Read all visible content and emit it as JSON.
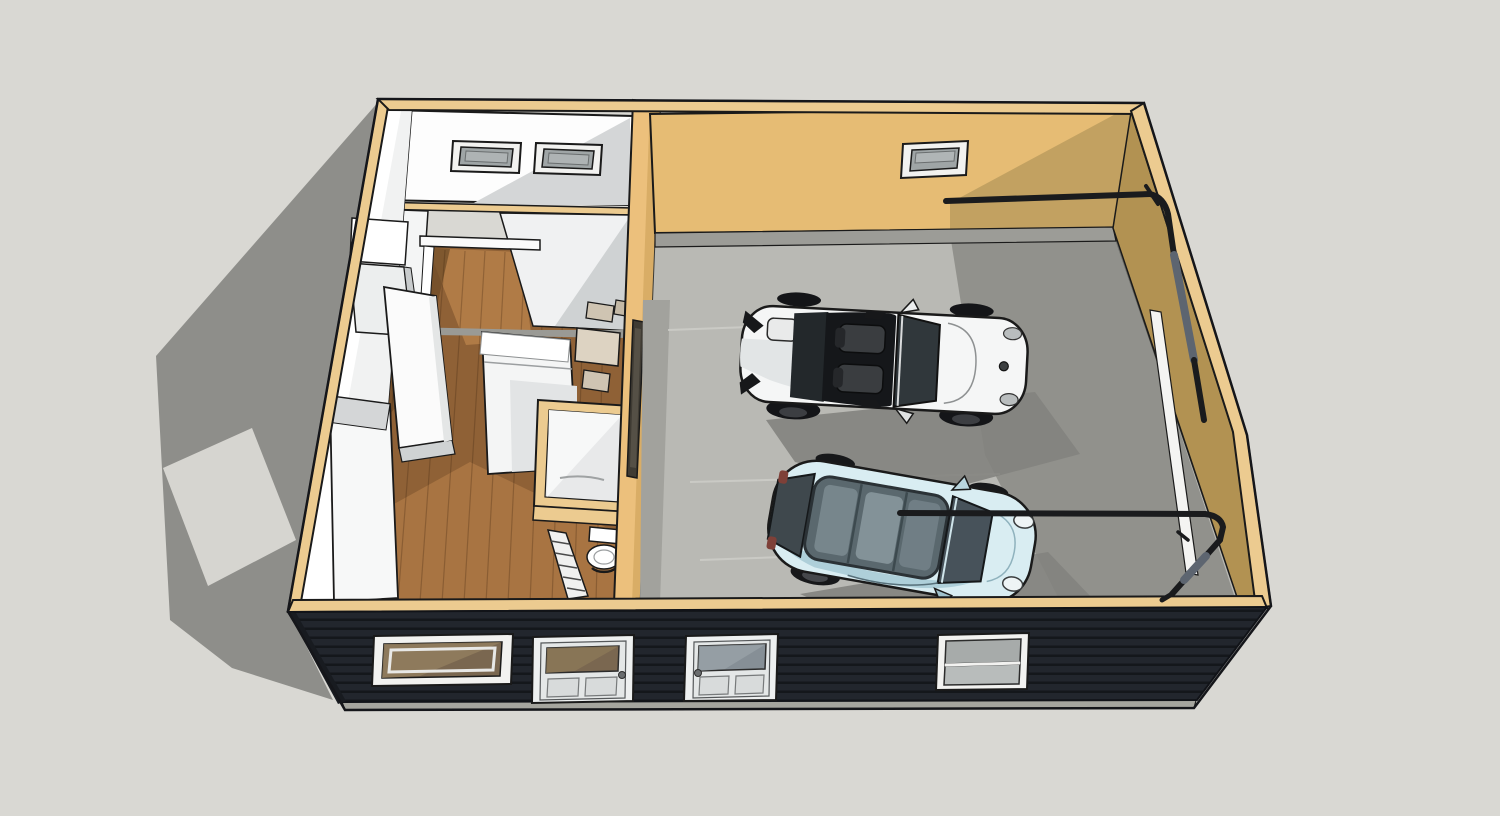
{
  "scene": {
    "type": "3d-model-viewport",
    "description": "Isometric cutaway 3D model of a garage apartment: two-car garage with white convertible and light blue hatchback, studio apartment with wood floor, bathroom and furniture, dark horizontal-siding front facade with two doors and two windows, garage door tracks on the right wall, shadow cast on ground to the left."
  },
  "labels": {
    "viewport": "3D model viewport",
    "ground": "Ground plane",
    "shadow": "Building shadow on ground",
    "shadow_light_patch": "Light patch through opening",
    "building": "Garage apartment building",
    "apartment": "Studio apartment interior",
    "apartment_back_wall": "Apartment back wall",
    "transom_window_1": "Transom window 1",
    "transom_window_2": "Transom window 2",
    "partition_wall": "Interior partition wall with cased opening",
    "hallway": "Wood floor hallway",
    "wood_floor": "Hardwood floor",
    "closet": "Closet cabinets",
    "counter": "Kitchen counter",
    "wardrobe": "Wardrobe cabinet",
    "bed": "Bed",
    "bathroom": "Bathroom with shower",
    "toilet": "Toilet",
    "ladder": "Ladder",
    "table": "Table with chairs",
    "divider_wall": "Partition wall between apartment and garage",
    "divider_window": "Window in partition wall",
    "garage": "Two-car garage interior",
    "garage_back_wall": "Garage back wall",
    "garage_window": "Garage back wall window",
    "garage_curb": "Concrete curb",
    "garage_floor": "Concrete garage floor",
    "east_wall": "Garage door wall",
    "door_jamb": "Garage door jamb",
    "track_rear": "Garage door track (rear)",
    "track_front": "Garage door track (front)",
    "white_car": "White convertible sports car",
    "blue_car": "Light blue compact hatchback",
    "west_wall": "West wall",
    "facade": "Front exterior wall, dark horizontal siding",
    "facade_plate": "Wall top plate",
    "foundation": "Concrete foundation strip",
    "facade_window_left": "Front window (apartment)",
    "facade_door_left": "Apartment entry door",
    "facade_door_right": "Garage entry door",
    "facade_window_right": "Front window (garage)"
  },
  "colors": {
    "background": "#d9d8d3",
    "ground_shadow": "#8e8e8a",
    "ground_light_patch": "#d6d5d0",
    "plate_tan": "#eccb90",
    "wall_tan": "#e6bc74",
    "wall_tan_shadow": "#c2a161",
    "wall_tan_dark": "#b29252",
    "divider_tan": "#ecc07c",
    "curb_gray": "#9c9c97",
    "garage_floor": "#b9b9b4",
    "garage_floor_shadow": "#84847f",
    "wood_floor": "#8f6136",
    "wood_floor_light": "#b07b46",
    "wood_floor_dark": "#6f4c28",
    "interior_white": "#fdfdfd",
    "interior_shade": "#d4d6d7",
    "siding_dark": "#22262d",
    "siding_line": "#14171b",
    "foundation_gray": "#a5a59e",
    "trim_white": "#f2f2f0",
    "glass_gray": "#9fa5a6",
    "glass_brown": "#7a6750",
    "car_white": "#f5f6f6",
    "car_white_shade": "#d2d5d6",
    "car_blue": "#d9edf2",
    "car_blue_shade": "#aecfd9",
    "glass_dark": "#30373b",
    "track_black": "#1a1b1d",
    "spring_gray": "#5d6570",
    "outline": "#1a1a1a"
  },
  "vehicles": [
    {
      "name": "white convertible sports car",
      "body_color": "#f5f6f6",
      "position": "rear parking spot",
      "facing": "garage door"
    },
    {
      "name": "light blue compact hatchback",
      "body_color": "#d9edf2",
      "position": "front parking spot",
      "facing": "garage door"
    }
  ]
}
